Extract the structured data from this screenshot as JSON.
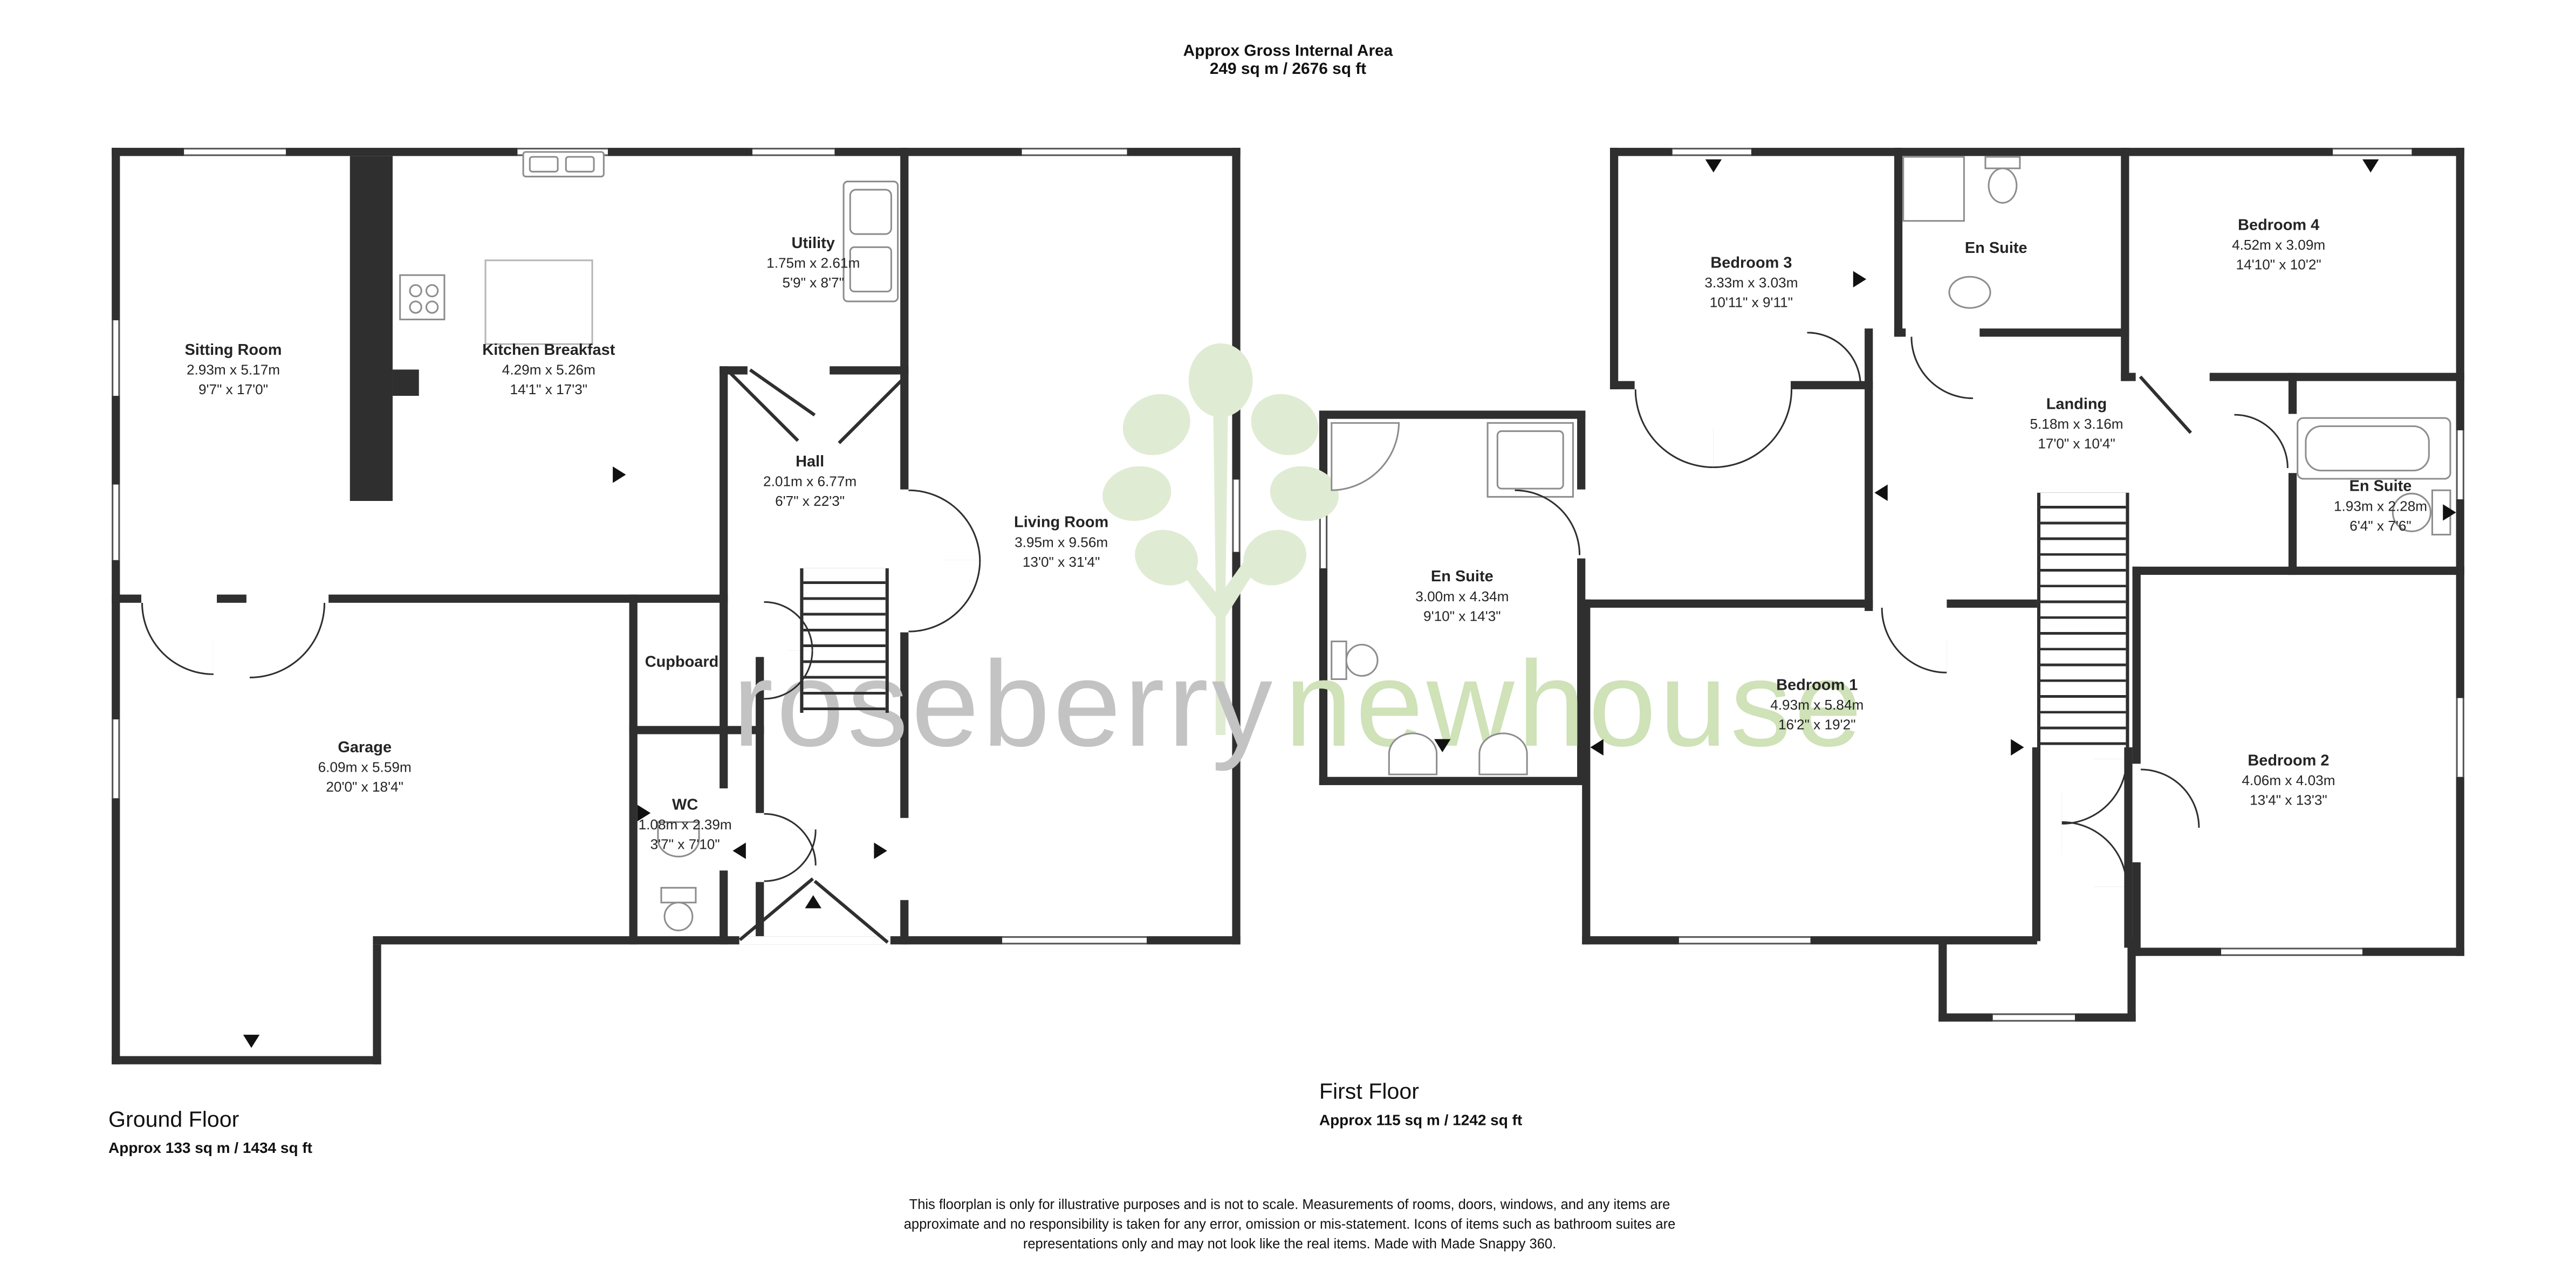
{
  "header": {
    "title": "Approx Gross Internal Area",
    "area": "249 sq m / 2676 sq ft"
  },
  "watermark": {
    "word1": "roseberry",
    "word2": "newhouse",
    "word1_color": "#c3c3c3",
    "word2_color": "#cfe2b8",
    "tree_color": "#e0ebd3"
  },
  "floors": [
    {
      "label": "Ground Floor",
      "area": "Approx 133 sq m / 1434 sq ft",
      "rooms": [
        {
          "name": "Sitting Room",
          "metric": "2.93m x 5.17m",
          "imperial": "9'7\" x 17'0\""
        },
        {
          "name": "Kitchen Breakfast",
          "metric": "4.29m x 5.26m",
          "imperial": "14'1\" x 17'3\""
        },
        {
          "name": "Utility",
          "metric": "1.75m x 2.61m",
          "imperial": "5'9\" x 8'7\""
        },
        {
          "name": "Hall",
          "metric": "2.01m x 6.77m",
          "imperial": "6'7\" x 22'3\""
        },
        {
          "name": "Living Room",
          "metric": "3.95m x 9.56m",
          "imperial": "13'0\" x 31'4\""
        },
        {
          "name": "Cupboard",
          "metric": "",
          "imperial": ""
        },
        {
          "name": "Garage",
          "metric": "6.09m x 5.59m",
          "imperial": "20'0\" x 18'4\""
        },
        {
          "name": "WC",
          "metric": "1.08m x 2.39m",
          "imperial": "3'7\" x 7'10\""
        }
      ]
    },
    {
      "label": "First Floor",
      "area": "Approx 115 sq m / 1242 sq ft",
      "rooms": [
        {
          "name": "Bedroom 3",
          "metric": "3.33m x 3.03m",
          "imperial": "10'11\" x 9'11\""
        },
        {
          "name": "En Suite",
          "metric": "",
          "imperial": ""
        },
        {
          "name": "Bedroom 4",
          "metric": "4.52m x 3.09m",
          "imperial": "14'10\" x 10'2\""
        },
        {
          "name": "Landing",
          "metric": "5.18m x 3.16m",
          "imperial": "17'0\" x 10'4\""
        },
        {
          "name": "En Suite",
          "metric": "1.93m x 2.28m",
          "imperial": "6'4\" x 7'6\""
        },
        {
          "name": "En Suite",
          "metric": "3.00m x 4.34m",
          "imperial": "9'10\" x 14'3\""
        },
        {
          "name": "Bedroom 1",
          "metric": "4.93m x 5.84m",
          "imperial": "16'2\" x 19'2\""
        },
        {
          "name": "Bedroom 2",
          "metric": "4.06m x 4.03m",
          "imperial": "13'4\" x 13'3\""
        }
      ]
    }
  ],
  "disclaimer": "This floorplan is only for illustrative purposes and is not to scale. Measurements of rooms, doors, windows, and any items are approximate and no responsibility is taken for any error, omission or mis-statement. Icons of items such as bathroom suites are representations only and may not look like the real items. Made with Made Snappy 360."
}
